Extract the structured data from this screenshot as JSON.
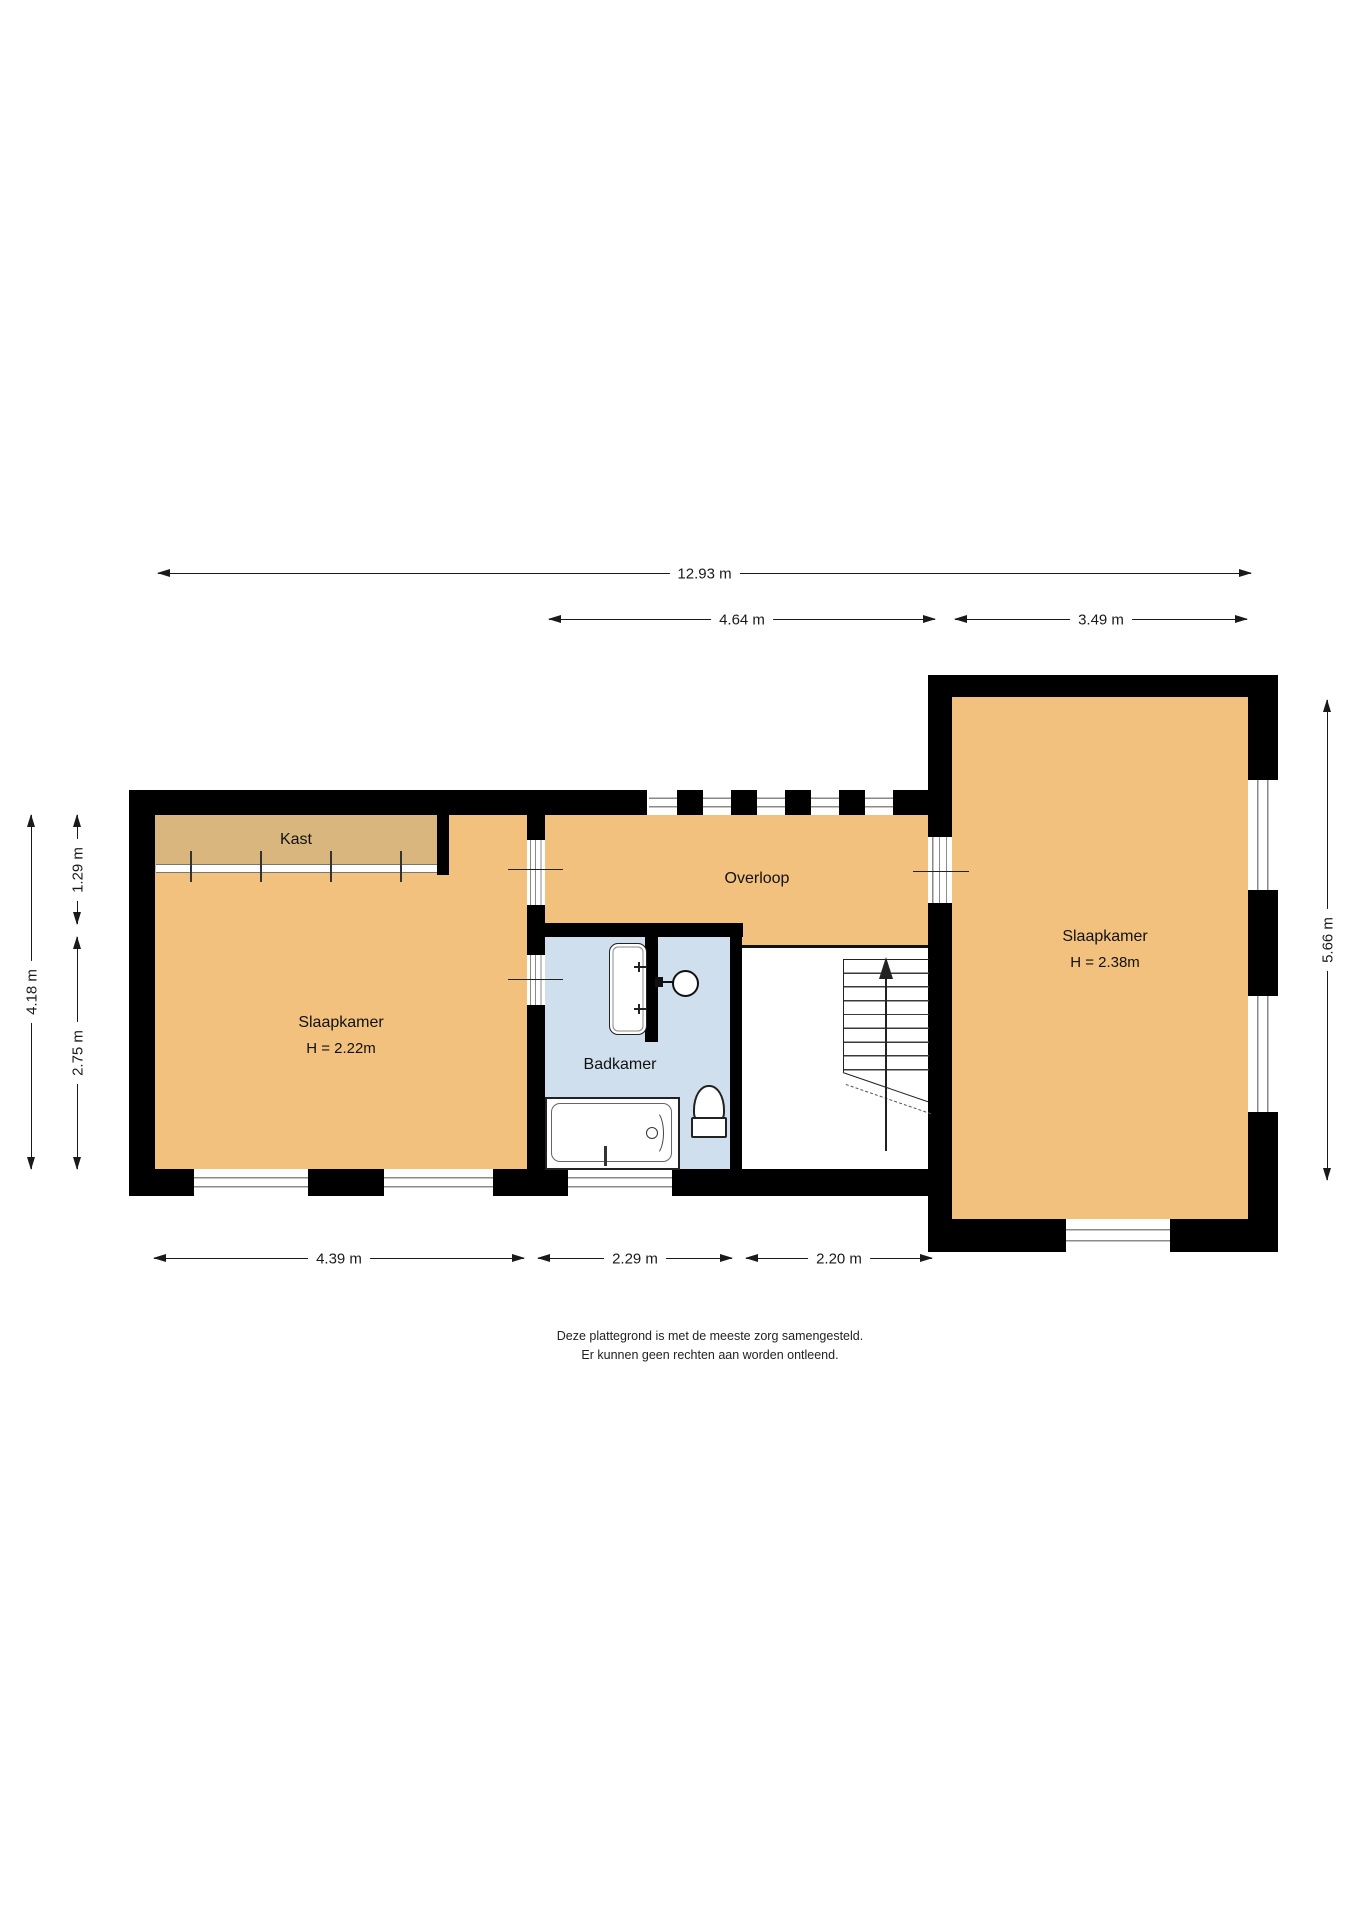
{
  "title": "Plattegrond verdieping",
  "colors": {
    "floor": "#F2C17D",
    "closet": "#D8B67E",
    "bath": "#D0DFED",
    "wall": "#000000",
    "window_line": "#8A8A8A",
    "dim": "#1A1A1A",
    "bg": "#FFFFFF"
  },
  "rooms": {
    "kast": {
      "label": "Kast"
    },
    "overloop": {
      "label": "Overloop"
    },
    "slaapkamer_left": {
      "label": "Slaapkamer",
      "height": "H = 2.22m"
    },
    "badkamer": {
      "label": "Badkamer"
    },
    "slaapkamer_right": {
      "label": "Slaapkamer",
      "height": "H = 2.38m"
    }
  },
  "dimensions": {
    "total_width": {
      "label": "12.93 m"
    },
    "middle_width": {
      "label": "4.64 m"
    },
    "right_width": {
      "label": "3.49 m"
    },
    "left_room_width": {
      "label": "4.39 m"
    },
    "bath_width": {
      "label": "2.29 m"
    },
    "stairs_width": {
      "label": "2.20 m"
    },
    "left_total_depth": {
      "label": "4.18 m"
    },
    "overloop_depth": {
      "label": "1.29 m"
    },
    "bath_depth": {
      "label": "2.75 m"
    },
    "right_depth": {
      "label": "5.66 m"
    }
  },
  "disclaimer": {
    "line1": "Deze plattegrond is met de meeste zorg samengesteld.",
    "line2": "Er kunnen geen rechten aan worden ontleend."
  }
}
